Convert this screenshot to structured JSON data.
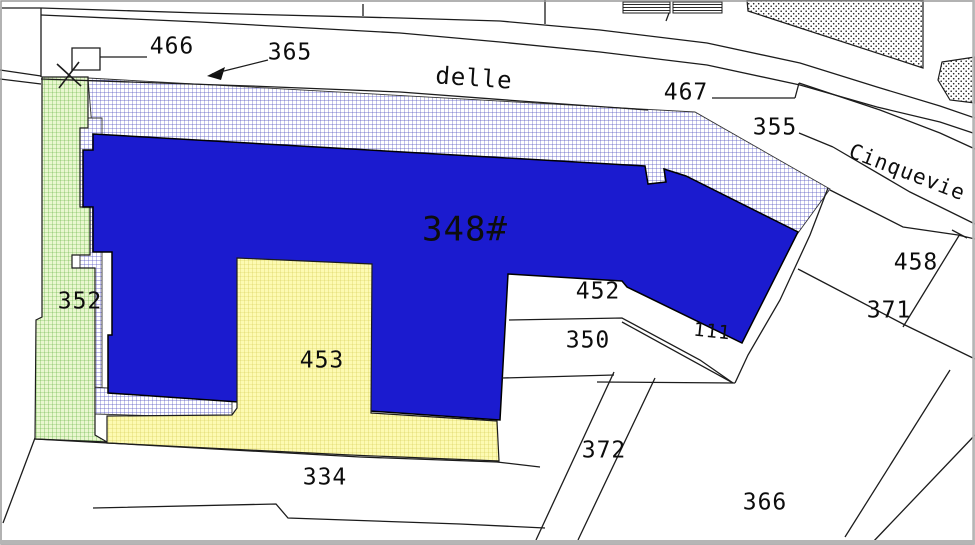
{
  "map": {
    "title": "cadastral-parcel-map",
    "width": 975,
    "height": 545,
    "colors": {
      "building_blue": "#1b1bcf",
      "hatch_line_blue": "#5050c0",
      "hatch_bg": "#ffffff",
      "green_bg": "#e9f7cf",
      "green_line": "#55aa33",
      "yellow_bg": "#fdfab2",
      "yellow_line": "#d2c84e",
      "line_ink": "#1c1c1c",
      "label_ink": "#0d0d0d",
      "frame_gray": "#b5b5b5",
      "solid_ink": "#111111",
      "white": "#ffffff"
    },
    "labels": [
      {
        "id": "parcel-label-466",
        "text": "466",
        "x": 172,
        "y": 47,
        "size": 23,
        "rotate": 0,
        "spacing": 1
      },
      {
        "id": "parcel-label-365",
        "text": "365",
        "x": 290,
        "y": 53,
        "size": 23,
        "rotate": 0,
        "spacing": 1
      },
      {
        "id": "street-name-delle",
        "text": "delle",
        "x": 474,
        "y": 79,
        "size": 24,
        "rotate": 4,
        "spacing": 9
      },
      {
        "id": "parcel-label-467",
        "text": "467",
        "x": 686,
        "y": 93,
        "size": 23,
        "rotate": 0,
        "spacing": 1
      },
      {
        "id": "parcel-label-355",
        "text": "355",
        "x": 775,
        "y": 128,
        "size": 23,
        "rotate": 0,
        "spacing": 1
      },
      {
        "id": "street-name-cinquevie",
        "text": "Cinquevie",
        "x": 907,
        "y": 173,
        "size": 21,
        "rotate": 21,
        "spacing": 2
      },
      {
        "id": "parcel-label-352",
        "text": "352",
        "x": 80,
        "y": 302,
        "size": 23,
        "rotate": 0,
        "spacing": 1
      },
      {
        "id": "parcel-label-348",
        "text": "348#",
        "x": 465,
        "y": 231,
        "size": 34,
        "rotate": 0,
        "spacing": 1
      },
      {
        "id": "parcel-label-452",
        "text": "452",
        "x": 598,
        "y": 292,
        "size": 23,
        "rotate": 0,
        "spacing": 1
      },
      {
        "id": "parcel-label-350",
        "text": "350",
        "x": 588,
        "y": 341,
        "size": 23,
        "rotate": 0,
        "spacing": 1
      },
      {
        "id": "parcel-label-453",
        "text": "453",
        "x": 322,
        "y": 361,
        "size": 23,
        "rotate": 0,
        "spacing": 1
      },
      {
        "id": "parcel-label-111",
        "text": "111",
        "x": 712,
        "y": 332,
        "size": 19,
        "rotate": 6,
        "spacing": 3
      },
      {
        "id": "parcel-label-458",
        "text": "458",
        "x": 916,
        "y": 263,
        "size": 23,
        "rotate": 0,
        "spacing": 1
      },
      {
        "id": "parcel-label-371",
        "text": "371",
        "x": 889,
        "y": 311,
        "size": 23,
        "rotate": 0,
        "spacing": 1
      },
      {
        "id": "parcel-label-372",
        "text": "372",
        "x": 604,
        "y": 451,
        "size": 23,
        "rotate": 0,
        "spacing": 1
      },
      {
        "id": "parcel-label-334",
        "text": "334",
        "x": 325,
        "y": 478,
        "size": 23,
        "rotate": 0,
        "spacing": 1
      },
      {
        "id": "parcel-label-366",
        "text": "366",
        "x": 765,
        "y": 503,
        "size": 23,
        "rotate": 0,
        "spacing": 1
      }
    ],
    "regions": [
      {
        "id": "court-hatch-top-band",
        "fill": "pattern:crosshatch-blue",
        "stroke": "#333333",
        "sw": 0.9,
        "points": "88,78 695,112 830,189 798,233 686,190 93,140"
      },
      {
        "id": "court-hatch-left-strip",
        "fill": "pattern:crosshatch-blue",
        "stroke": "#333333",
        "sw": 0.9,
        "points": "80,118 102,118 102,414 80,414"
      },
      {
        "id": "court-hatch-bottom-strip",
        "fill": "pattern:crosshatch-blue",
        "stroke": "#333333",
        "sw": 0.9,
        "points": "92,387 232,396 232,418 95,414"
      },
      {
        "id": "parcel-352-green-strip",
        "fill": "pattern:grid-green",
        "stroke": "#1c1c1c",
        "sw": 1.2,
        "points": "42,77 88,77 88,128 80,128 80,207 90,207 90,255 72,255 72,268 95,268 95,435 107,442 35,439 36,320 42,317"
      },
      {
        "id": "road-building-hatched-a",
        "fill": "pattern:hlines",
        "stroke": "#1c1c1c",
        "sw": 1,
        "points": "623,2 670,2 670,13 623,13"
      },
      {
        "id": "road-building-hatched-b",
        "fill": "pattern:hlines",
        "stroke": "#1c1c1c",
        "sw": 1,
        "points": "673,2 722,2 722,13 673,13"
      },
      {
        "id": "stippled-parcel-large",
        "fill": "pattern:dots",
        "stroke": "#1c1c1c",
        "sw": 1.2,
        "points": "747,0 923,0 923,68 748,11"
      },
      {
        "id": "stippled-parcel-small",
        "fill": "pattern:dots",
        "stroke": "#1c1c1c",
        "sw": 1.2,
        "points": "942,62 975,57 975,103 950,100 938,80"
      },
      {
        "id": "small-building-footprint",
        "fill": "#ffffff",
        "stroke": "#1c1c1c",
        "sw": 1.3,
        "points": "72,48 100,48 100,70 72,70"
      },
      {
        "id": "building-348-solid",
        "fill": "color:building_blue",
        "stroke": "#000000",
        "sw": 1.5,
        "points": "93,134 645,166 648,184 666,182 664,169 686,176 798,232 742,343 627,287 622,281 508,274 500,420 108,393 108,335 112,335 112,252 93,252 93,207 83,207 83,150 93,150"
      },
      {
        "id": "parcel-453-yellow",
        "fill": "pattern:grid-yellow",
        "stroke": "#1c1c1c",
        "sw": 1.2,
        "points": "237,258 372,264 371,413 497,421 499,461 350,455 107,443 107,416 232,415 237,408"
      },
      {
        "id": "leader-365-arrowhead",
        "fill": "color:solid_ink",
        "stroke": "none",
        "sw": 0,
        "points": "207,76 225,67 221,80"
      }
    ],
    "lines": [
      {
        "id": "border-top-left-h",
        "points": "2,8 41,8"
      },
      {
        "id": "border-top-left-v",
        "points": "41,8 41,77"
      },
      {
        "id": "road-edge-left-1",
        "points": "0,70 41,76"
      },
      {
        "id": "road-edge-left-2",
        "points": "0,79 41,84"
      },
      {
        "id": "road-edge-far",
        "points": "41,8 200,13 400,18 500,21 600,30 707,43 800,63 877,87 940,106 975,118"
      },
      {
        "id": "road-edge-mid",
        "points": "41,15 200,22 400,33 500,42 600,52 707,65 800,85 877,107 940,122 973,133"
      },
      {
        "id": "road-edge-near",
        "points": "41,79 250,86 400,92 520,101 648,110"
      },
      {
        "id": "boundary-tick-363",
        "points": "363,4 363,16"
      },
      {
        "id": "boundary-tick-545",
        "points": "545,0 545,24"
      },
      {
        "id": "tick-top-building",
        "points": "669,13 666,21"
      },
      {
        "id": "leader-467",
        "points": "712,98 795,98"
      },
      {
        "id": "leader-467-jog",
        "points": "795,98 799,83"
      },
      {
        "id": "road-edge-right",
        "points": "799,83 880,110 940,133 975,149"
      },
      {
        "id": "leader-355",
        "points": "799,133 833,147"
      },
      {
        "id": "parcel-line-355-lower",
        "points": "833,147 910,192 975,224"
      },
      {
        "id": "parcel-line-458-upper",
        "points": "830,190 903,227 958,235 975,239"
      },
      {
        "id": "divider-458-371",
        "points": "960,234 903,327"
      },
      {
        "id": "divider-458-tick",
        "points": "952,230 967,238"
      },
      {
        "id": "court-outline-right",
        "points": "828,188 810,235 780,300 748,355 735,383"
      },
      {
        "id": "parcel-line-371-lower",
        "points": "798,269 905,325 975,359"
      },
      {
        "id": "strip-111-lower",
        "points": "622,322 733,383"
      },
      {
        "id": "parcel-line-below-tip",
        "points": "597,382 735,383"
      },
      {
        "id": "divider-452-350",
        "points": "509,320 622,318 700,360 733,383"
      },
      {
        "id": "divider-350-lower",
        "points": "502,378 614,375"
      },
      {
        "id": "path-372-west",
        "points": "614,372 536,540"
      },
      {
        "id": "path-372-east",
        "points": "655,378 578,540"
      },
      {
        "id": "boundary-334-upper",
        "points": "35,439 360,457 497,462 540,467"
      },
      {
        "id": "boundary-334-lower",
        "points": "93,508 276,504 288,518 460,524 545,528"
      },
      {
        "id": "boundary-bottom-left-diag",
        "points": "35,438 3,523"
      },
      {
        "id": "wedge-366-west",
        "points": "950,370 845,537"
      },
      {
        "id": "wedge-366-east",
        "points": "975,435 872,543"
      },
      {
        "id": "leader-466",
        "points": "100,57 147,57"
      },
      {
        "id": "leader-365",
        "points": "268,60 212,74"
      },
      {
        "id": "survey-cross-stroke-a",
        "points": "57,64 81,86",
        "w": 1.6
      },
      {
        "id": "survey-cross-stroke-b",
        "points": "79,62 59,88",
        "w": 1.6
      }
    ]
  }
}
